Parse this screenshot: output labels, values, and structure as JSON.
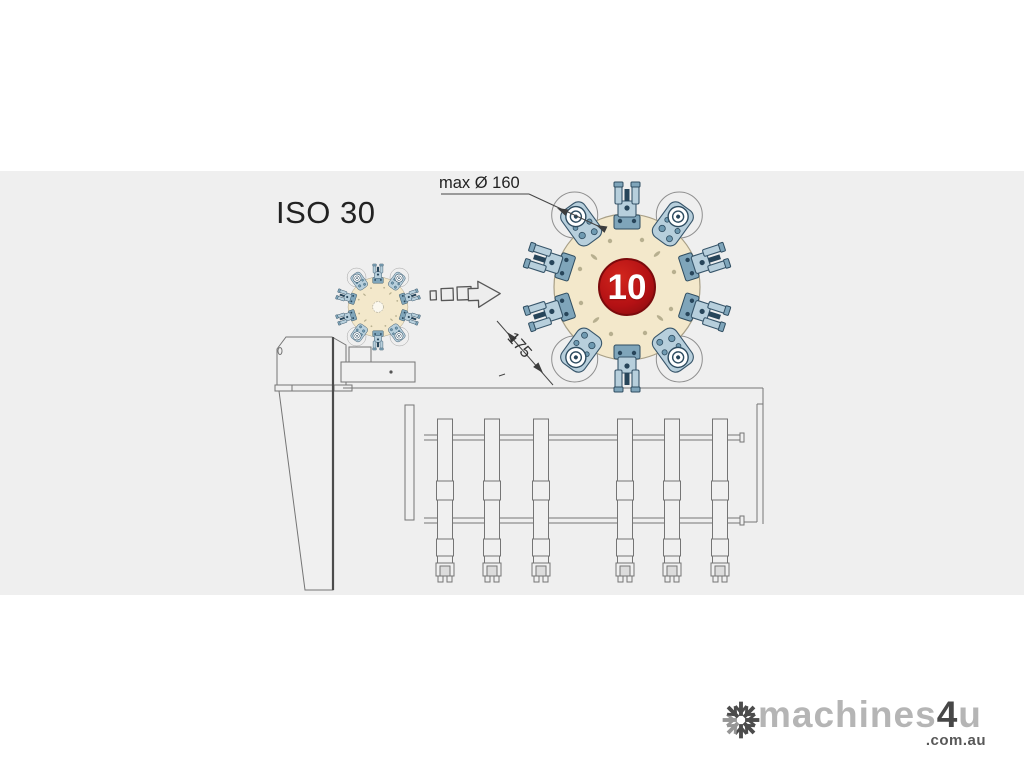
{
  "colors": {
    "page_bg": "#ffffff",
    "panel_bg": "#efefef",
    "disc_cream": "#f3e8cb",
    "badge_red": "#b41114",
    "badge_text": "#ffffff",
    "tool_steel_light": "#b7cfdc",
    "tool_steel_dark": "#27455a",
    "line_gray": "#757575",
    "logo_light_gray": "#b5b5b5",
    "logo_dark_gray": "#474747"
  },
  "annotations": {
    "spindle_taper_label": "ISO 30",
    "max_tool_diameter_label": "max Ø 160",
    "turret_tool_count": "10",
    "turret_pitch_dimension": "175"
  },
  "watermark": {
    "brand_prefix": "machines",
    "brand_number": "4",
    "brand_suffix": "u",
    "brand_tld": ".com.au"
  }
}
